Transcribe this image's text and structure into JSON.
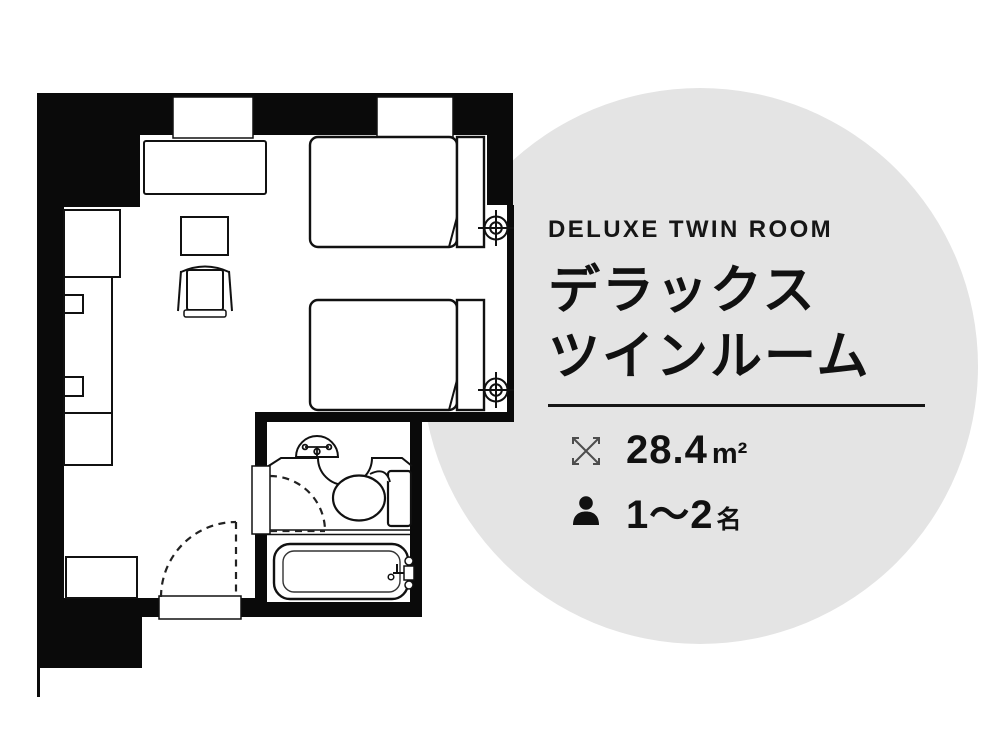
{
  "page": {
    "background": "#ffffff"
  },
  "info_circle": {
    "bg_color": "#e4e4e4",
    "text_color": "#161616",
    "title_en": "DELUXE TWIN ROOM",
    "title_ja_line1": "デラックス",
    "title_ja_line2": "ツインルーム",
    "area": {
      "icon": "expand-arrows-icon",
      "value": "28.4",
      "unit": "m²"
    },
    "capacity": {
      "icon": "person-icon",
      "value": "1〜2",
      "unit": "名"
    }
  },
  "floorplan": {
    "wall_color": "#0a0a0a",
    "line_color": "#111111",
    "icon_gray": "#4d4d4d",
    "features": [
      "sofa",
      "coffee-table",
      "armchair",
      "wardrobe-counter",
      "closet",
      "entry-cabinet",
      "twin-bed-1",
      "twin-bed-2",
      "window-1",
      "window-2",
      "sprinkler-symbol-1",
      "sprinkler-symbol-2",
      "bathroom",
      "washbasin",
      "faucet",
      "toilet",
      "bathtub",
      "bathroom-door",
      "entrance-door"
    ]
  }
}
